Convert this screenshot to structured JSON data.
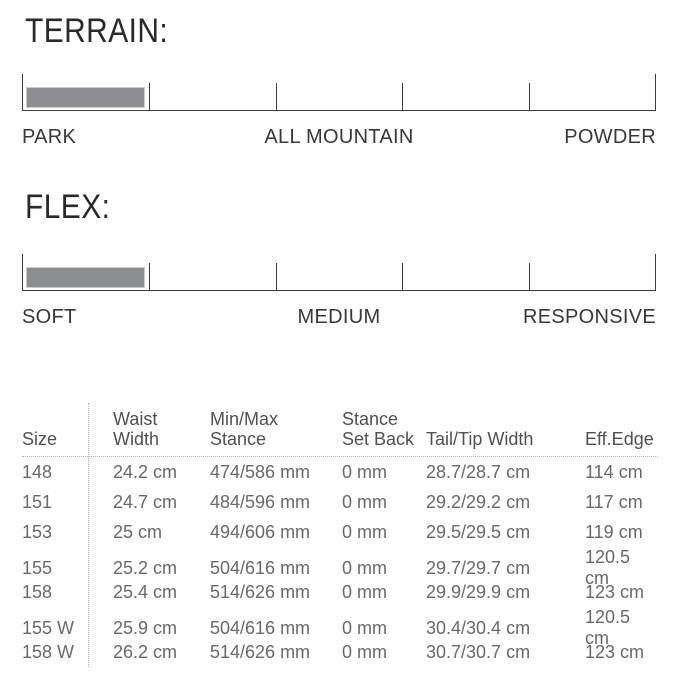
{
  "terrain": {
    "heading": "TERRAIN:",
    "scale_labels": {
      "left": "PARK",
      "center": "ALL MOUNTAIN",
      "right": "POWDER"
    },
    "level": {
      "segment": 1,
      "of_segments": 5
    }
  },
  "flex": {
    "heading": "FLEX:",
    "scale_labels": {
      "left": "SOFT",
      "center": "MEDIUM",
      "right": "RESPONSIVE"
    },
    "level": {
      "segment": 1,
      "of_segments": 5
    }
  },
  "style": {
    "bar_fill": "#8d8e90"
  },
  "spec_table": {
    "headers": [
      {
        "top": "",
        "bottom": "Size"
      },
      {
        "top": "Waist",
        "bottom": "Width"
      },
      {
        "top": "Min/Max",
        "bottom": "Stance"
      },
      {
        "top": "Stance",
        "bottom": "Set Back"
      },
      {
        "top": "",
        "bottom": "Tail/Tip Width"
      },
      {
        "top": "",
        "bottom": "Eff.Edge"
      }
    ],
    "rows": [
      [
        "148",
        "24.2 cm",
        "474/586 mm",
        "0 mm",
        "28.7/28.7 cm",
        "114 cm"
      ],
      [
        "151",
        "24.7 cm",
        "484/596 mm",
        "0 mm",
        "29.2/29.2 cm",
        "117 cm"
      ],
      [
        "153",
        "25 cm",
        "494/606 mm",
        "0 mm",
        "29.5/29.5 cm",
        "119 cm"
      ],
      [
        "155",
        "25.2 cm",
        "504/616 mm",
        "0 mm",
        "29.7/29.7 cm",
        "120.5 cm"
      ],
      [
        "158",
        "25.4 cm",
        "514/626 mm",
        "0 mm",
        "29.9/29.9 cm",
        "123 cm"
      ],
      [
        "155 W",
        "25.9 cm",
        "504/616 mm",
        "0 mm",
        "30.4/30.4 cm",
        "120.5 cm"
      ],
      [
        "158 W",
        "26.2 cm",
        "514/626 mm",
        "0 mm",
        "30.7/30.7 cm",
        "123 cm"
      ]
    ]
  }
}
